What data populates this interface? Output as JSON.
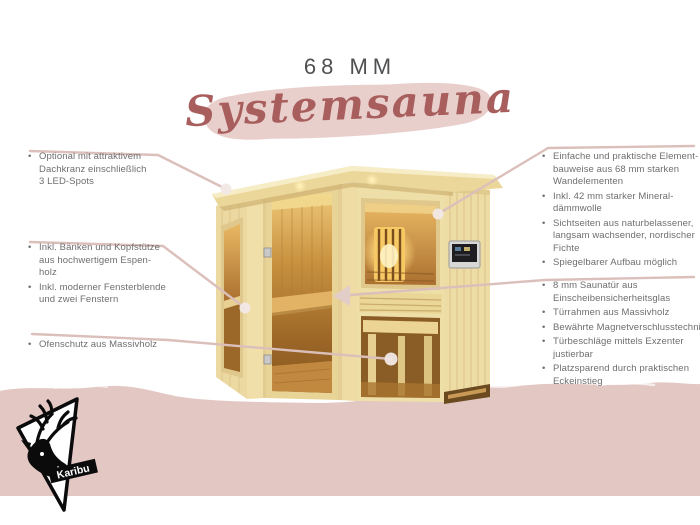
{
  "header": {
    "size_label": "68 MM",
    "title": "Systemsauna"
  },
  "left_notes": [
    {
      "items": [
        {
          "text": "Optional mit attraktivem\nDachkranz einschließlich\n3 LED-Spots"
        }
      ]
    },
    {
      "items": [
        {
          "text": "Inkl. Bänken und Kopfstütze\naus hochwertigem Espen-\nholz"
        },
        {
          "text": "Inkl. moderner Fensterblende\nund zwei Fenstern"
        }
      ]
    },
    {
      "items": [
        {
          "text": "Ofenschutz aus Massivholz"
        }
      ]
    }
  ],
  "right_notes": [
    {
      "items": [
        {
          "text": "Einfache und praktische Element-\nbauweise aus 68 mm starken\nWandelementen"
        },
        {
          "text": "Inkl. 42 mm starker Mineral-\ndämmwolle"
        },
        {
          "text": "Sichtseiten aus naturbelassener,\nlangsam wachsender, nordischer\nFichte"
        },
        {
          "text": "Spiegelbarer Aufbau möglich"
        }
      ]
    },
    {
      "items": [
        {
          "text": "8 mm Saunatür aus\nEinscheibensicherheitsglas"
        },
        {
          "text": "Türrahmen aus Massivholz"
        },
        {
          "text": "Bewährte Magnetverschlusstechnik"
        },
        {
          "text": "Türbeschläge mittels Exzenter\njustierbar"
        },
        {
          "text": "Platzsparend durch praktischen\nEckeinstieg"
        }
      ]
    }
  ],
  "logo": {
    "brand": "Karibu",
    "icon": "deer-icon"
  },
  "colors": {
    "band_pink": "#e2c7c3",
    "brush_pink": "#e8cfcb",
    "title_red": "#a85e5c",
    "callout_line": "#dbbfba",
    "wood_light": "#eedfa8",
    "text_gray": "#6e6e70"
  }
}
